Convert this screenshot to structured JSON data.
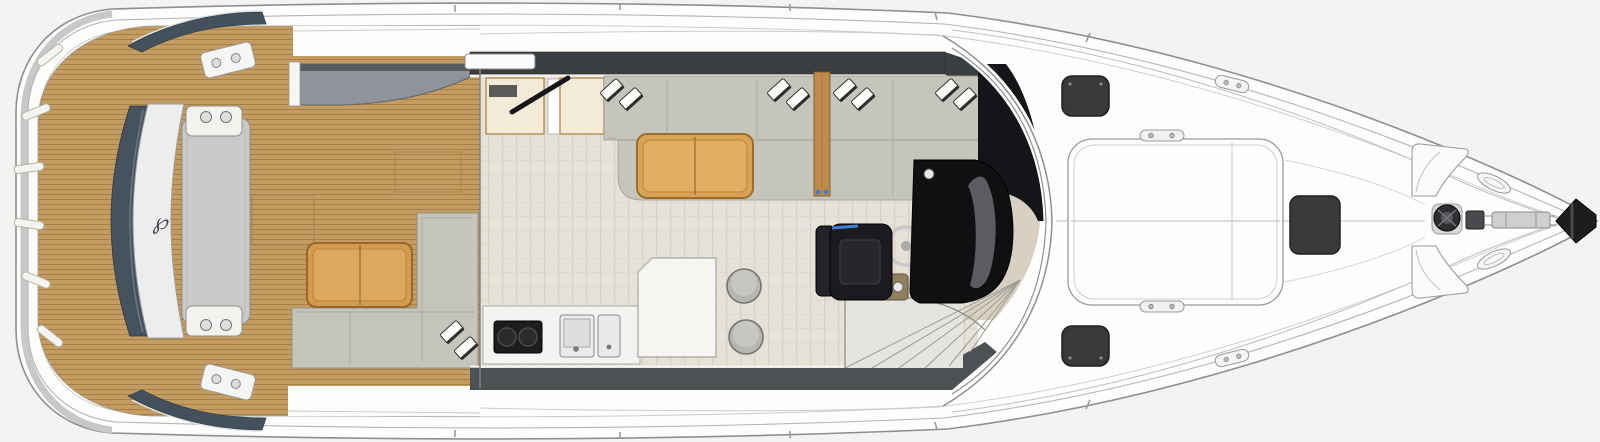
{
  "document": {
    "type": "yacht-deck-floorplan",
    "view": "top-down",
    "orientation": "bow-right"
  },
  "branding": {
    "transom_logo_glyph": "℘"
  },
  "palette": {
    "background": "#f3f3f1",
    "hull_fill": "#fdfdfc",
    "hull_line": "#8f8f8f",
    "teak": "#c49c62",
    "teak_seam": "#a5814a",
    "interior_floor": "#e7e2d8",
    "floor_seam": "#d7d1c5",
    "upholstery_gray": "#c6c5bc",
    "table_wood": "#d49a4e",
    "table_trim": "#96682a",
    "window_band": "#3b3e40",
    "lower_band": "#4e5154",
    "transom_navy": "#46535f",
    "pad_gray": "#c9c9c7",
    "console_black": "#141518",
    "seat_black": "#1b1b1f",
    "seat_accent_blue": "#3f7fd6",
    "helm_carpet": "#d8d1c1",
    "hatch_dark": "#39393c",
    "galley_counter": "#f4f3f1",
    "cooktop_black": "#1d1d1f",
    "cabinet_cream": "#f3ead8",
    "cabinet_trim": "#b68c4e"
  },
  "areas": [
    {
      "id": "swim-platform"
    },
    {
      "id": "transom-lounger"
    },
    {
      "id": "cockpit"
    },
    {
      "id": "cockpit-sofa"
    },
    {
      "id": "cockpit-table"
    },
    {
      "id": "wet-bar"
    },
    {
      "id": "salon"
    },
    {
      "id": "galley"
    },
    {
      "id": "salon-sofa"
    },
    {
      "id": "coffee-table"
    },
    {
      "id": "helm-station"
    },
    {
      "id": "companionway-stairs"
    },
    {
      "id": "foredeck"
    },
    {
      "id": "foredeck-sunpad"
    },
    {
      "id": "anchor-windlass"
    },
    {
      "id": "bow"
    }
  ],
  "equipment": {
    "cooktop_burners": 2,
    "galley_sinks": 2,
    "bar_stools": 2,
    "foredeck_hatches": 3,
    "bow_locker_hatches": 2,
    "salon_pillow_pairs": 4,
    "cockpit_pillow_pair": 1,
    "platform_lights": 6
  }
}
